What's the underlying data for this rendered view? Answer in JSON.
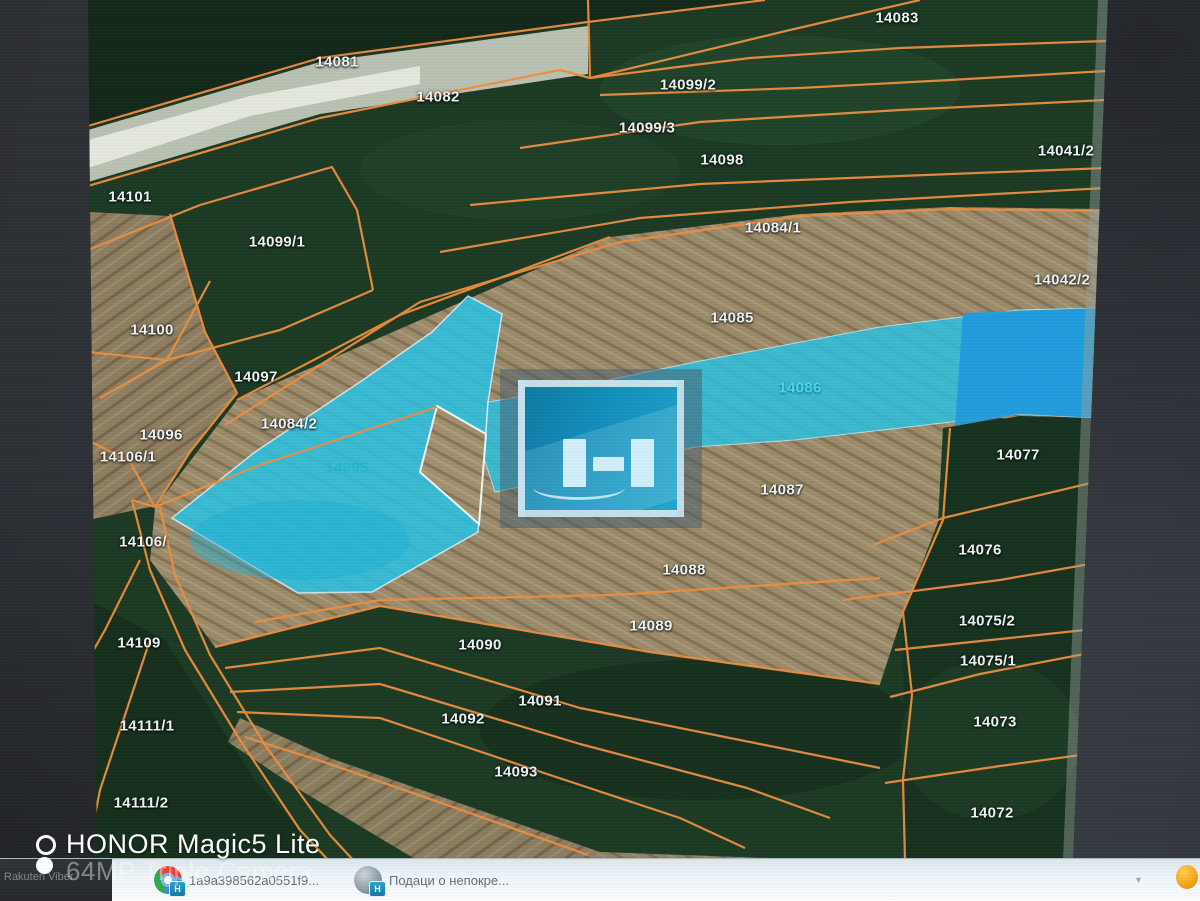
{
  "map": {
    "description": "cadastral aerial map with orange parcel boundaries",
    "colors": {
      "boundary_orange": "#ef8f3f",
      "highlight_cyan": "#29c4e6",
      "highlight_blue": "#1e9ade",
      "field_tan": "#a3906f",
      "field_green": "#1c3a24",
      "label_white": "#eef3f5"
    },
    "highlighted_parcels": [
      "14095",
      "14086"
    ],
    "parcels": [
      {
        "id": "14083",
        "x": 897,
        "y": 18,
        "cls": ""
      },
      {
        "id": "14081",
        "x": 337,
        "y": 62,
        "cls": ""
      },
      {
        "id": "14099/2",
        "x": 688,
        "y": 85,
        "cls": ""
      },
      {
        "id": "14082",
        "x": 438,
        "y": 97,
        "cls": ""
      },
      {
        "id": "14099/3",
        "x": 647,
        "y": 128,
        "cls": ""
      },
      {
        "id": "14041/2",
        "x": 1066,
        "y": 151,
        "cls": ""
      },
      {
        "id": "14098",
        "x": 722,
        "y": 160,
        "cls": ""
      },
      {
        "id": "14101",
        "x": 130,
        "y": 197,
        "cls": ""
      },
      {
        "id": "14084/1",
        "x": 773,
        "y": 228,
        "cls": ""
      },
      {
        "id": "14099/1",
        "x": 277,
        "y": 242,
        "cls": ""
      },
      {
        "id": "14042/2",
        "x": 1062,
        "y": 280,
        "cls": ""
      },
      {
        "id": "14085",
        "x": 732,
        "y": 318,
        "cls": ""
      },
      {
        "id": "14100",
        "x": 152,
        "y": 330,
        "cls": ""
      },
      {
        "id": "14097",
        "x": 256,
        "y": 377,
        "cls": ""
      },
      {
        "id": "14086",
        "x": 800,
        "y": 388,
        "cls": "cyan"
      },
      {
        "id": "14084/2",
        "x": 289,
        "y": 424,
        "cls": ""
      },
      {
        "id": "14096",
        "x": 161,
        "y": 435,
        "cls": ""
      },
      {
        "id": "14106/1",
        "x": 128,
        "y": 457,
        "cls": ""
      },
      {
        "id": "14077",
        "x": 1018,
        "y": 455,
        "cls": ""
      },
      {
        "id": "14095",
        "x": 347,
        "y": 468,
        "cls": "cyan-dim"
      },
      {
        "id": "14087",
        "x": 782,
        "y": 490,
        "cls": ""
      },
      {
        "id": "14106/",
        "x": 143,
        "y": 542,
        "cls": ""
      },
      {
        "id": "14076",
        "x": 980,
        "y": 550,
        "cls": ""
      },
      {
        "id": "14088",
        "x": 684,
        "y": 570,
        "cls": ""
      },
      {
        "id": "14075/2",
        "x": 987,
        "y": 621,
        "cls": ""
      },
      {
        "id": "14089",
        "x": 651,
        "y": 626,
        "cls": ""
      },
      {
        "id": "14109",
        "x": 139,
        "y": 643,
        "cls": ""
      },
      {
        "id": "14090",
        "x": 480,
        "y": 645,
        "cls": ""
      },
      {
        "id": "14075/1",
        "x": 988,
        "y": 661,
        "cls": ""
      },
      {
        "id": "14091",
        "x": 540,
        "y": 701,
        "cls": ""
      },
      {
        "id": "14092",
        "x": 463,
        "y": 719,
        "cls": ""
      },
      {
        "id": "14073",
        "x": 995,
        "y": 722,
        "cls": ""
      },
      {
        "id": "14111/1",
        "x": 147,
        "y": 726,
        "cls": ""
      },
      {
        "id": "14093",
        "x": 516,
        "y": 772,
        "cls": ""
      },
      {
        "id": "14111/2",
        "x": 141,
        "y": 803,
        "cls": ""
      },
      {
        "id": "14072",
        "x": 992,
        "y": 813,
        "cls": ""
      }
    ]
  },
  "watermark": {
    "line1": "HONOR Magic5 Lite",
    "line2": "64MP Triple Camera"
  },
  "taskbar": {
    "items": [
      {
        "label": "Rakuten Viber"
      },
      {
        "label": "1a9a398562a0551f9..."
      },
      {
        "label": "Подаци о непокре..."
      }
    ]
  }
}
